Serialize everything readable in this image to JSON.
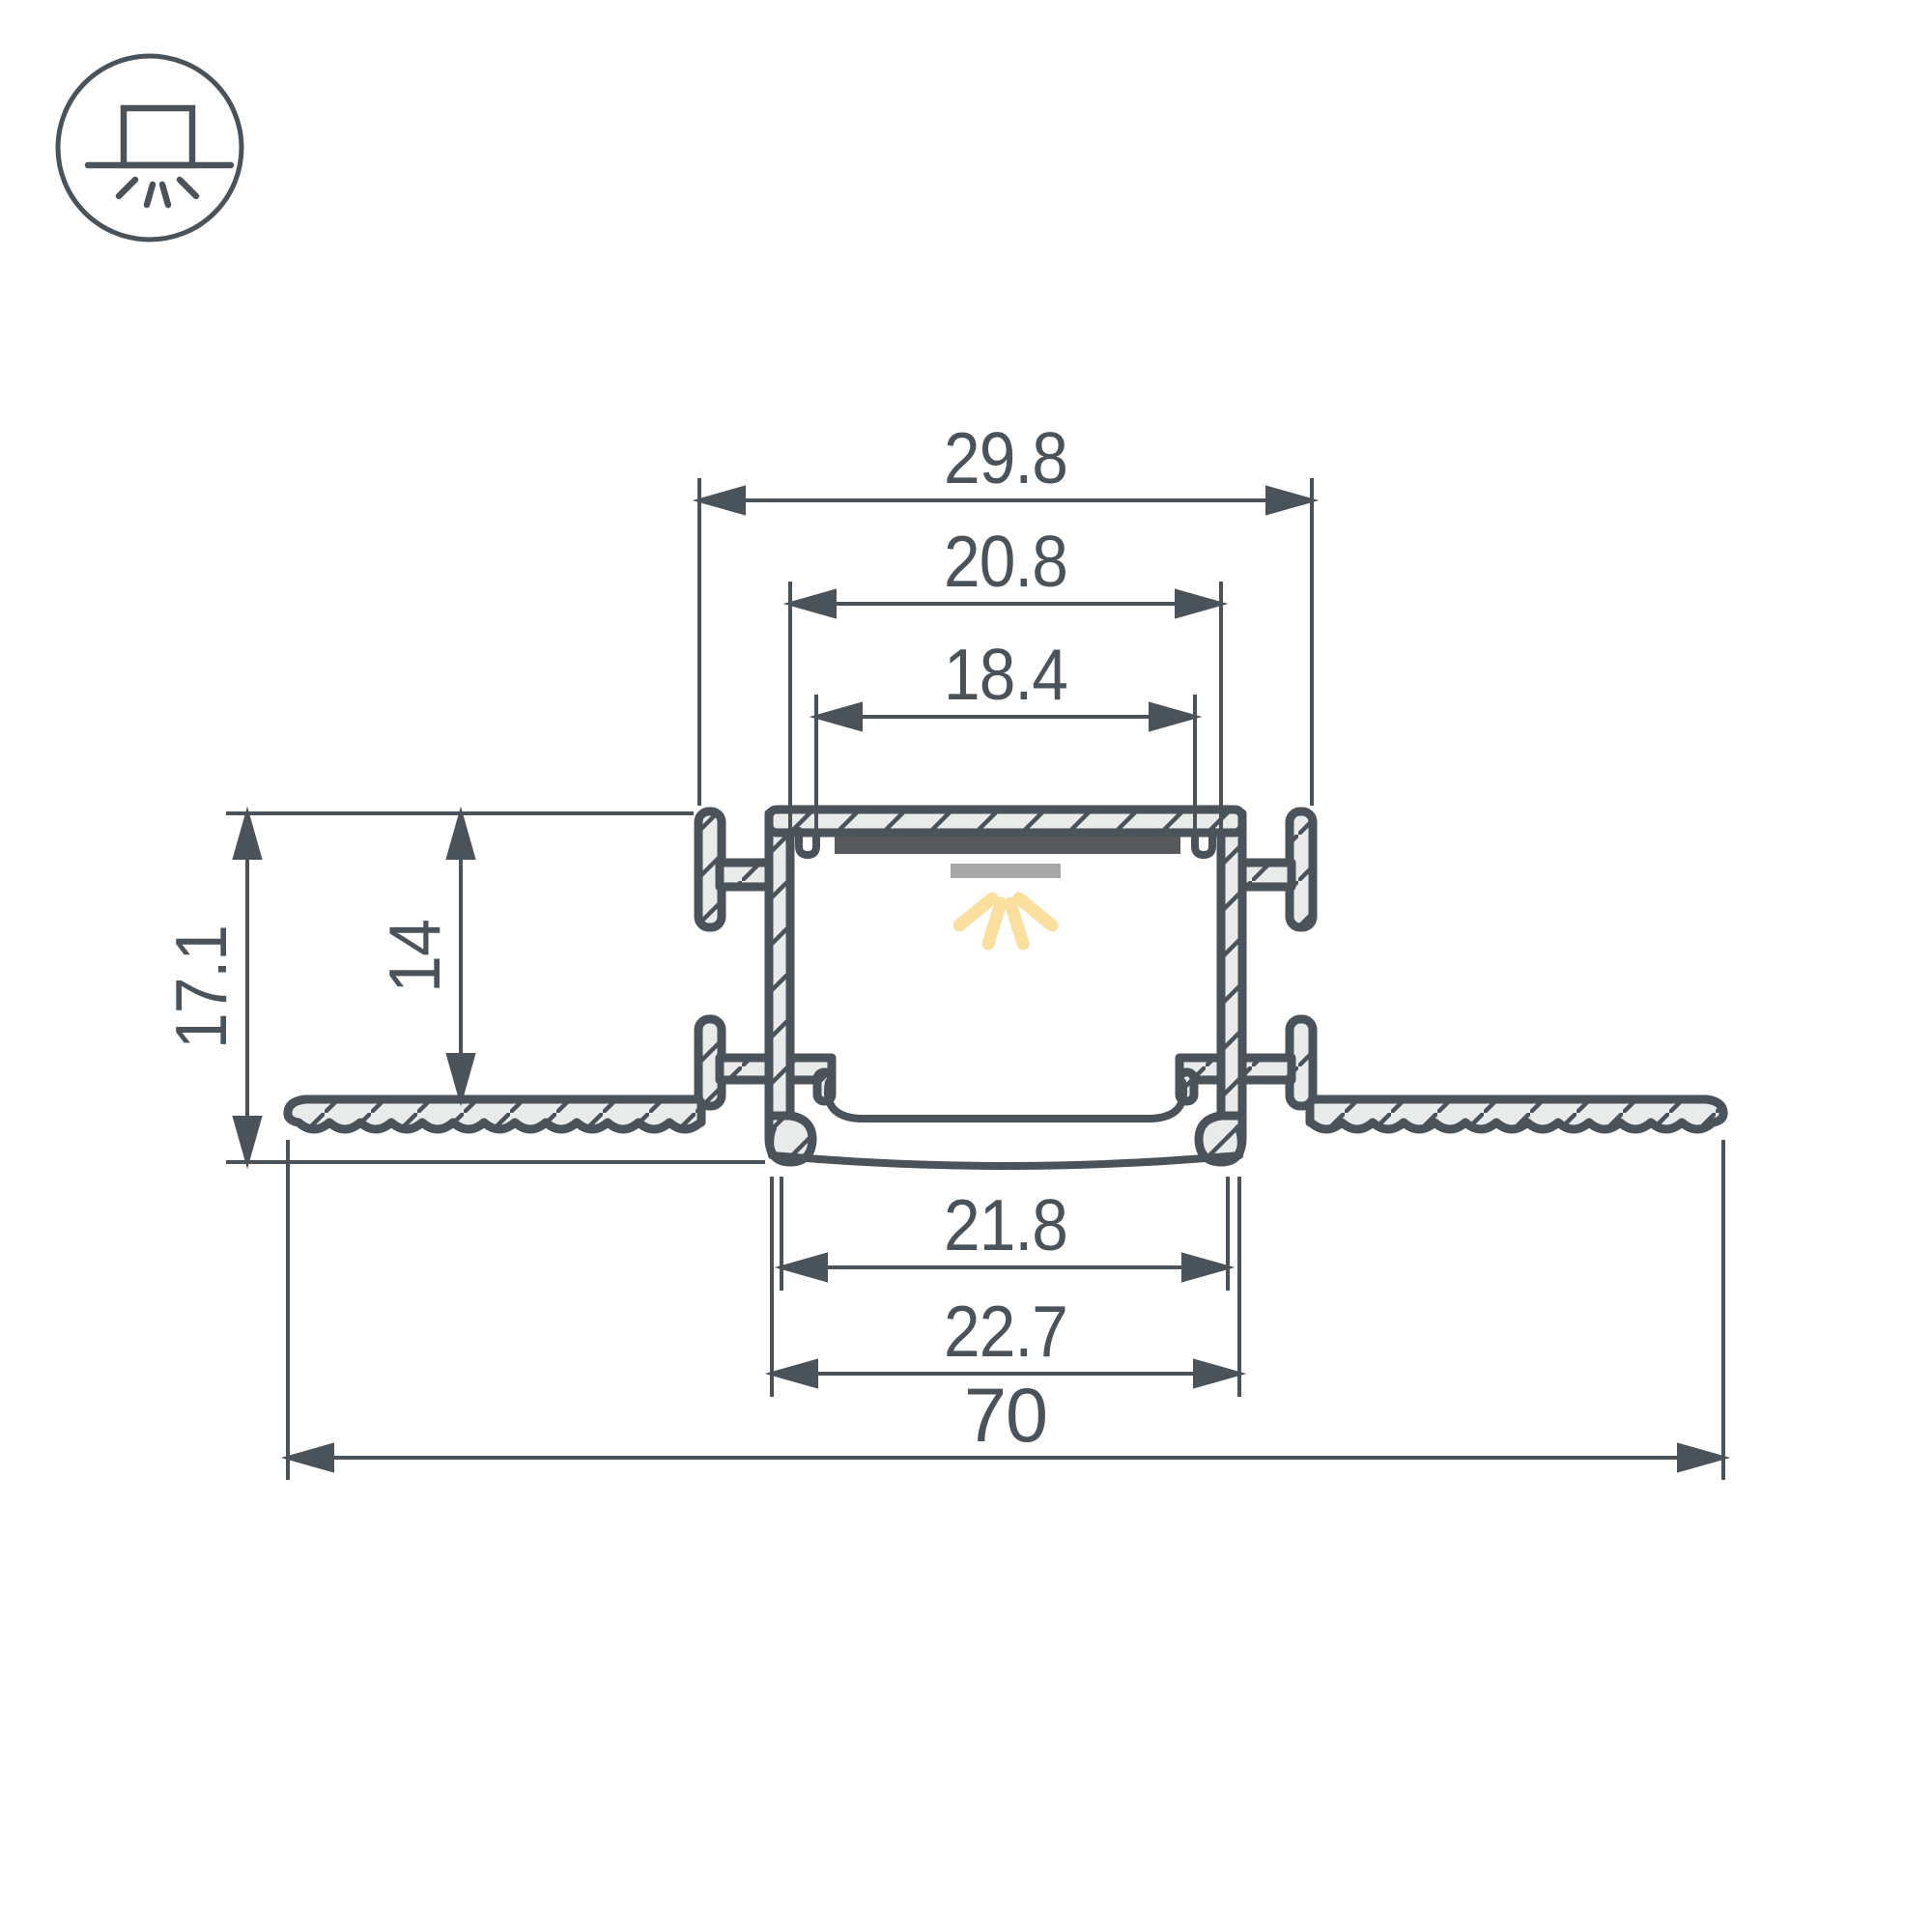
{
  "drawing": {
    "type": "technical cross-section diagram",
    "subject": "recessed trimless LED aluminium profile in plasterboard (gypsum) ceiling",
    "units": "mm",
    "colors": {
      "outline": "#4a525a",
      "profile_fill": "#e9eaea",
      "background": "#ffffff",
      "pcb_strip": "#57595c",
      "led_strip": "#a8a8a8",
      "light_rays": "#fadf9f"
    }
  },
  "icon": {
    "name": "recessed-downlight-mounting-icon",
    "description": "circle with box recessed above ceiling line and light rays shining down"
  },
  "dims": {
    "outer_top_width": {
      "label": "29.8"
    },
    "inner_top_width": {
      "label": "20.8"
    },
    "pcb_pocket_width": {
      "label": "18.4"
    },
    "total_height": {
      "label": "17.1"
    },
    "recess_depth": {
      "label": "14"
    },
    "opening_width": {
      "label": "21.8"
    },
    "lip_outer_width": {
      "label": "22.7"
    },
    "overall_width": {
      "label": "70"
    }
  }
}
